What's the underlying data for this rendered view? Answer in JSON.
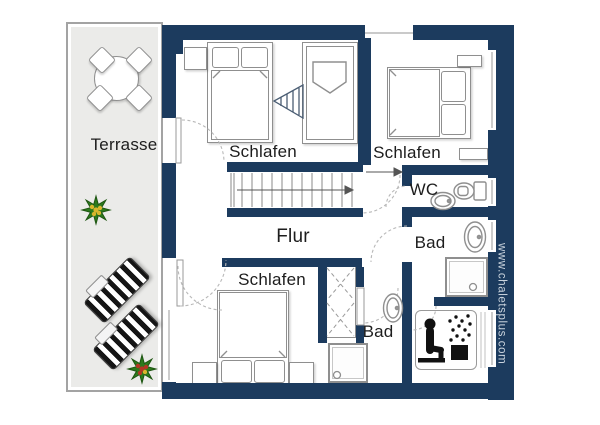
{
  "page": {
    "type": "floor-plan",
    "background": "#ffffff"
  },
  "colors": {
    "wall": "#1c3b5e",
    "terrace_fill": "#ebebe9",
    "furniture_outline": "#8f8f8f",
    "label_text": "#1d1d1d",
    "watermark_text": "#c9d3dd",
    "lounger_stripe": "#151515",
    "plant_green": "#2c7a1c",
    "plant_center_yellow": "#d8b62c",
    "plant_center_red": "#b43624"
  },
  "rooms": {
    "terrace": {
      "label": "Terrasse"
    },
    "bedroom_nw": {
      "label": "Schlafen"
    },
    "bedroom_ne": {
      "label": "Schlafen"
    },
    "bedroom_s": {
      "label": "Schlafen"
    },
    "hallway": {
      "label": "Flur"
    },
    "wc": {
      "label": "WC"
    },
    "bathroom_e": {
      "label": "Bad"
    },
    "bathroom_s": {
      "label": "Bad"
    }
  },
  "watermark": {
    "text": "www.chaletsplus.com"
  },
  "icons": {
    "terrace": [
      "round-table-icon",
      "chair-icon",
      "potted-plant-icon",
      "sun-lounger-icon"
    ],
    "bedroom_nw": [
      "double-bed-icon",
      "single-bed-icon",
      "ladder-icon",
      "nightstand-icon"
    ],
    "bedroom_ne": [
      "double-bed-icon",
      "nightstand-icon"
    ],
    "bedroom_s": [
      "double-bed-icon",
      "nightstand-icon",
      "wardrobe-icon"
    ],
    "hallway": [
      "stairs-icon",
      "direction-arrow-icon",
      "door-swing-icon"
    ],
    "wc": [
      "toilet-icon",
      "washbasin-icon"
    ],
    "bathroom_e": [
      "washbasin-icon",
      "shower-icon"
    ],
    "bathroom_s": [
      "washbasin-icon",
      "shower-icon"
    ],
    "sauna": [
      "sauna-person-heater-icon"
    ]
  }
}
